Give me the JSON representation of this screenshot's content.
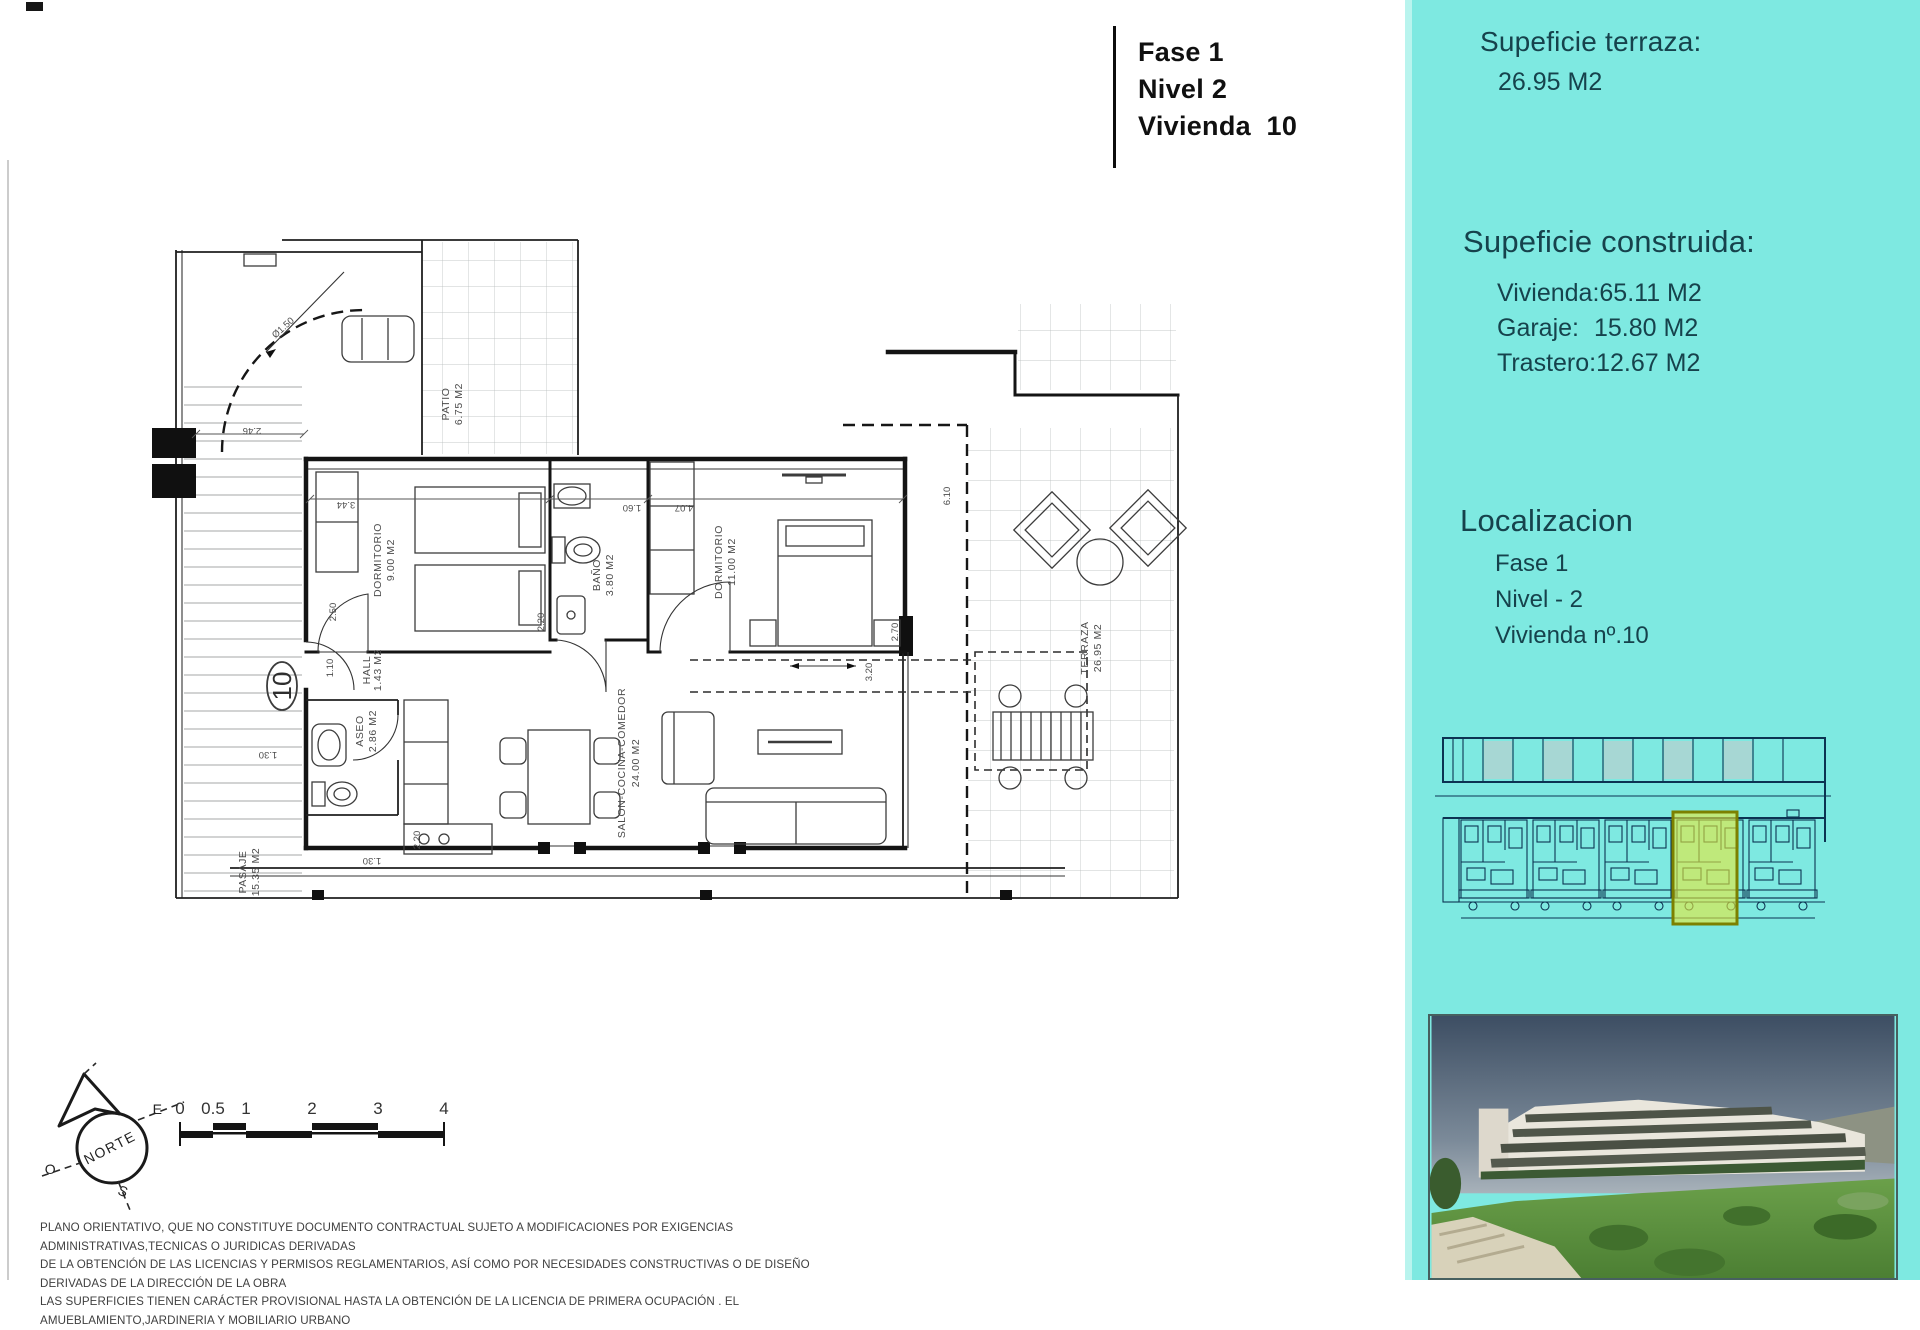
{
  "title_block": {
    "lines": [
      "Fase 1",
      "Nivel 2",
      "Vivienda  10"
    ]
  },
  "sidebar": {
    "accent_color": "#7ee9e1",
    "highlight_color": "#e6e83c",
    "terrace": {
      "heading": "Supeficie terraza:",
      "value": "26.95 M2"
    },
    "built": {
      "heading": "Supeficie construida:",
      "items": [
        {
          "label": "Vivienda:",
          "value": "65.11 M2"
        },
        {
          "label": "Garaje:",
          "value": "15.80 M2"
        },
        {
          "label": "Trastero:",
          "value": "12.67 M2"
        }
      ]
    },
    "location": {
      "heading": "Localizacion",
      "lines": [
        "Fase 1",
        "Nivel - 2",
        "Vivienda nº.10"
      ]
    }
  },
  "plan": {
    "unit_number": "10",
    "rooms": [
      {
        "name": "DORMITORIO",
        "area": "9.00 M2"
      },
      {
        "name": "BAÑO",
        "area": "3.80 M2"
      },
      {
        "name": "DORMITORIO",
        "area": "11.00 M2"
      },
      {
        "name": "HALL",
        "area": "1.43 M2"
      },
      {
        "name": "ASEO",
        "area": "2.86 M2"
      },
      {
        "name": "SALON-COCINA-COMEDOR",
        "area": "24.00 M2"
      },
      {
        "name": "TERRAZA",
        "area": "26.95 M2"
      },
      {
        "name": "PATIO",
        "area": "6.75 M2"
      },
      {
        "name": "PASAJE",
        "area": "15.35 M2"
      }
    ],
    "dimensions": [
      "2.46",
      "3.44",
      "1.60",
      "4.07",
      "2.50",
      "1.10",
      "2.20",
      "2.20",
      "6.10",
      "3.20",
      "2.70",
      "1.30",
      "1.30",
      "Ø1.50"
    ]
  },
  "compass": {
    "label": "NORTE",
    "east": "E",
    "west": "O",
    "south": "S"
  },
  "scale_bar": {
    "ticks": [
      "0",
      "0.5",
      "1",
      "2",
      "3",
      "4"
    ]
  },
  "disclaimer": {
    "lines": [
      "PLANO ORIENTATIVO, QUE NO CONSTITUYE DOCUMENTO CONTRACTUAL SUJETO A MODIFICACIONES POR EXIGENCIAS ADMINISTRATIVAS,TECNICAS O JURIDICAS DERIVADAS",
      "DE LA OBTENCIÓN DE LAS LICENCIAS Y PERMISOS REGLAMENTARIOS, ASÍ COMO POR NECESIDADES CONSTRUCTIVAS  O DE DISEÑO DERIVADAS DE LA DIRECCIÓN DE LA OBRA",
      "LAS SUPERFICIES TIENEN CARÁCTER PROVISIONAL HASTA LA OBTENCIÓN DE LA LICENCIA DE PRIMERA OCUPACIÓN . EL AMUEBLAMIENTO,JARDINERIA Y MOBILIARIO URBANO"
    ]
  }
}
